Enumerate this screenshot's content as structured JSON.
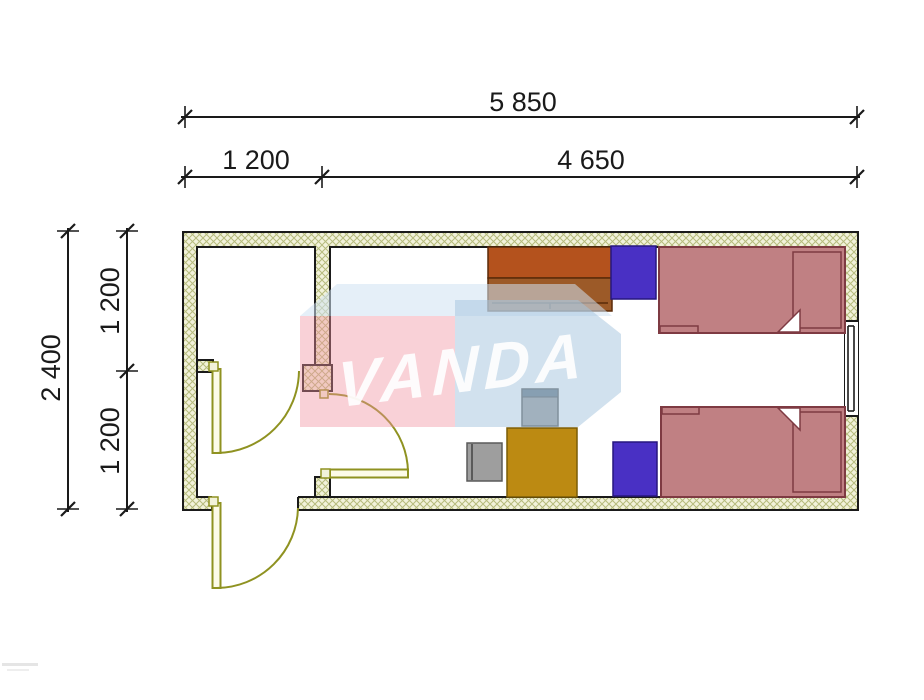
{
  "dimensions": {
    "width_total": {
      "label": "5 850"
    },
    "width_left": {
      "label": "1 200"
    },
    "width_right": {
      "label": "4 650"
    },
    "height_total": {
      "label": "2 400"
    },
    "height_top": {
      "label": "1 200"
    },
    "height_bottom": {
      "label": "1 200"
    }
  },
  "watermark": {
    "text": "VANDA"
  },
  "colors": {
    "dim": "#1a1a1a",
    "outline": "#1a1a1a",
    "wall-fill": "#f2f2da",
    "hatch-line": "#b6bb7d",
    "door": "#8f9221",
    "door-leaf-fill": "#fdfbe8",
    "bed-fill": "#c08083",
    "bed-border": "#7e3a42",
    "nightstand-fill": "#4930c4",
    "nightstand-border": "#27177e",
    "wardrobe-top": "#b4521d",
    "wardrobe-bottom": "#9c5a28",
    "wardrobe-border": "#5a2a08",
    "desk-fill": "#bc8a12",
    "desk-border": "#7a5c06",
    "chair-fill": "#9e9e9e",
    "chair-border": "#5a5a5a",
    "chair-back": "#6b7b87",
    "wm-pink": "#f0929f",
    "wm-blue": "#a3c3dd",
    "wm-top": "#cfe2f2",
    "wm-text": "#ffffff"
  }
}
